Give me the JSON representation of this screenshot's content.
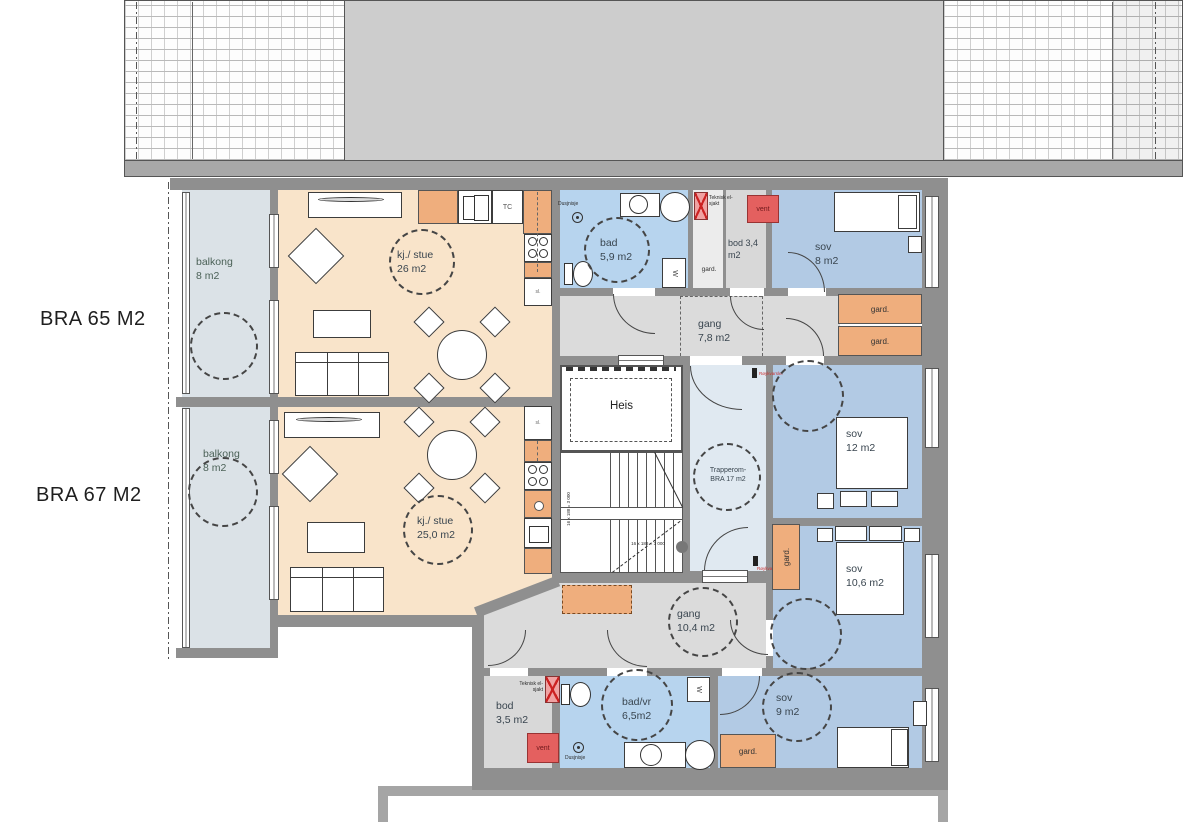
{
  "area_labels": {
    "bra65": "BRA 65 M2",
    "bra67": "BRA 67 M2"
  },
  "rooms": {
    "balkong_top": {
      "line1": "balkong",
      "line2": "8 m2"
    },
    "balkong_bottom": {
      "line1": "balkong",
      "line2": "8 m2"
    },
    "stue_top": {
      "line1": "kj./ stue",
      "line2": "26 m2"
    },
    "stue_bottom": {
      "line1": "kj./ stue",
      "line2": "25,0 m2"
    },
    "bad_top": {
      "line1": "bad",
      "line2": "5,9 m2"
    },
    "bod_top": {
      "line1": "bod 3,4",
      "line2": "m2"
    },
    "sov_8": {
      "line1": "sov",
      "line2": "8 m2"
    },
    "gang_top": {
      "line1": "gang",
      "line2": "7,8 m2"
    },
    "heis": {
      "label": "Heis"
    },
    "trapperom": {
      "line1": "Trapperom-",
      "line2": "BRA 17 m2"
    },
    "sov_12": {
      "line1": "sov",
      "line2": "12 m2"
    },
    "sov_10_6": {
      "line1": "sov",
      "line2": "10,6 m2"
    },
    "gang_bottom": {
      "line1": "gang",
      "line2": "10,4 m2"
    },
    "bod_bottom": {
      "line1": "bod",
      "line2": "3,5 m2"
    },
    "bad_vr": {
      "line1": "bad/vr",
      "line2": "6,5m2"
    },
    "sov_9": {
      "line1": "sov",
      "line2": "9 m2"
    }
  },
  "fixtures": {
    "tc": "TC",
    "sl_top": "sl.",
    "sl_bottom": "sl.",
    "w_top": "W",
    "w_bottom": "W",
    "dusjnisje_top": "Dusjnisje",
    "dusjnisje_bottom": "Dusjnisje",
    "teknisk_top": {
      "line1": "Teknisk el-",
      "line2": "sjakt"
    },
    "teknisk_bottom": {
      "line1": "Teknisk el-",
      "line2": "sjakt"
    },
    "vent_top": "vent",
    "vent_bottom": "vent",
    "gard_shaft": "gard.",
    "gard_sov8_upper": "gard.",
    "gard_sov8_lower": "gard.",
    "gard_sov10_6": "gard.",
    "gard_sov9": "gard.",
    "smoke_top": "Røykvarsler",
    "smoke_bottom": "Røykvarsler",
    "stair_dim_upper": "16 x 188 = 3 000",
    "stair_dim_lower": "16 x 188 = 3 000"
  },
  "colors": {
    "floor_living": "#f9e4ca",
    "floor_bath": "#b7d4ee",
    "floor_bedroom": "#b2cae4",
    "floor_balcony": "#dbe2e7",
    "floor_hall": "#dbdbdb",
    "floor_stairroom": "#e0e9f1",
    "cabinet_orange": "#efae7d",
    "shaft_red": "#e4605f",
    "wall_gray": "#8f8f8f"
  }
}
